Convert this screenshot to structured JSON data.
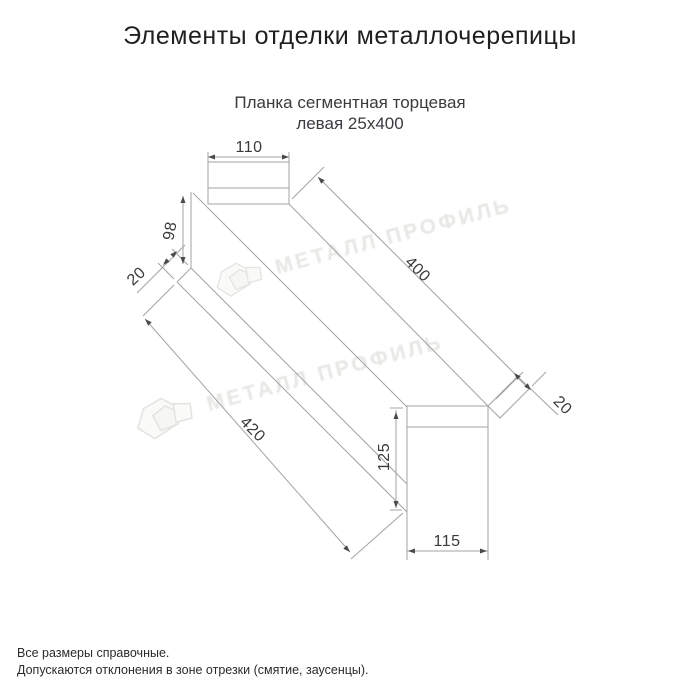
{
  "page": {
    "title": "Элементы отделки металлочерепицы"
  },
  "product": {
    "subtitle_line1": "Планка сегментная торцевая",
    "subtitle_line2": "левая 25х400"
  },
  "watermark": {
    "text": "МЕТАЛЛ ПРОФИЛЬ"
  },
  "drawing": {
    "line_color": "#a3a3a8",
    "arrow_color": "#4a4a4a",
    "dim_text_color": "#3a3a3a",
    "dimensions": [
      {
        "label": "110",
        "x": 249,
        "y": 148,
        "rot": 0
      },
      {
        "label": "98",
        "x": 171,
        "y": 231,
        "rot": -80
      },
      {
        "label": "20",
        "x": 137,
        "y": 277,
        "rot": -42
      },
      {
        "label": "400",
        "x": 417,
        "y": 270,
        "rot": 45
      },
      {
        "label": "20",
        "x": 562,
        "y": 406,
        "rot": 45
      },
      {
        "label": "420",
        "x": 252,
        "y": 430,
        "rot": 45
      },
      {
        "label": "125",
        "x": 385,
        "y": 457,
        "rot": -90
      },
      {
        "label": "115",
        "x": 447,
        "y": 542,
        "rot": 0
      }
    ]
  },
  "footer": {
    "line1": "Все размеры справочные.",
    "line2": "Допускаются отклонения в зоне отрезки (смятие, заусенцы)."
  }
}
